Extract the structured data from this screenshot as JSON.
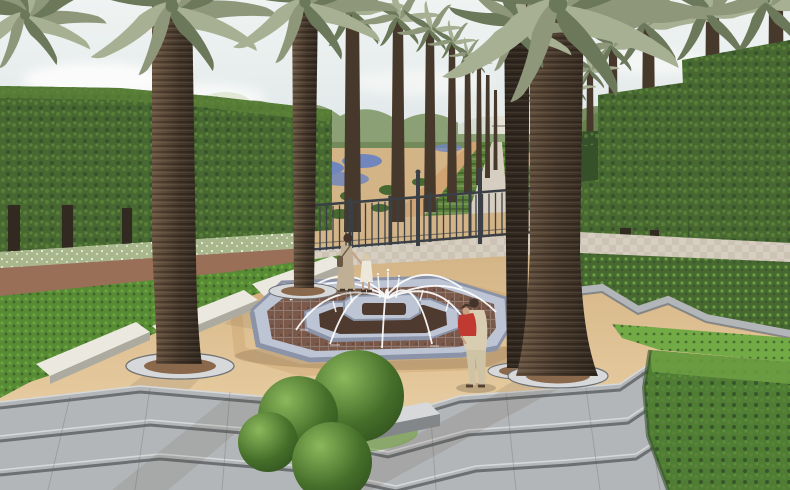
{
  "scene": {
    "type": "3d-architectural-rendering",
    "title": "Formal palm garden plaza with octagonal mosaic fountain",
    "time_of_day": "hazy daylight",
    "elements": {
      "sky": "pale hazy sky with soft white clouds",
      "background": "flowering treeline and a long receding avenue of palm trees",
      "left_hedge": "tall clipped hedge wall with a white-flower border and reddish gravel path",
      "right_hedges": "stepped clipped hedge walls with exposed trunks",
      "parterre": "central axis of rectangular planting strips with blue flower patches and a paved walk",
      "fence": "low dark metal railing with posts and taller gate posts separating plaza from gardens",
      "plaza": "sand-coloured esplanade with tall palms set in circular ringed tree pits",
      "fountain": "two-tier octagonal fountain, blue-grey tiled rims, reddish mosaic water basin, arcing white jets",
      "topiary": "cluster of clipped ball shrubs in a stone planter between step flights",
      "steps": "broad grey granite steps crossing the whole foreground",
      "planting_beds": "zig-zag stone-edged groundcover beds and a large clipped hedge block at lower right"
    },
    "people": [
      {
        "id": "woman-with-child",
        "description": "woman in a beige dress with shoulder bag holding hands with a small child in white, walking away",
        "position": "upper-left of fountain"
      },
      {
        "id": "man-with-child",
        "description": "man in cream clothes carrying a child in a red shirt, standing at the fountain edge",
        "position": "right of fountain"
      }
    ],
    "counts": {
      "foreground_palms": 4,
      "topiary_balls": 4,
      "fountain_jets": 9,
      "fence_posts": 7
    }
  },
  "palette": {
    "sky_top": "#eff3f2",
    "sky_low": "#d4dee1",
    "cloud": "#fdfdfc",
    "haze": "#e9ece8",
    "treeline": "#8ca076",
    "treeline_dark": "#5f7843",
    "blossom": "#dce3cd",
    "hedge_dark": "#36512a",
    "hedge_mid": "#476931",
    "hedge_light": "#5c8439",
    "hedge_top": "#6fa044",
    "hedge_bright": "#4f7d33",
    "bed_green": "#578c34",
    "bed_light": "#72aa45",
    "frond": "#8e977a",
    "frond_dark": "#6b785a",
    "frond_light": "#a8b093",
    "trunk_light": "#6e5944",
    "trunk_dark": "#46382b",
    "trunk_deep": "#322920",
    "sand": "#e1c497",
    "sand_light": "#edd8b0",
    "sand_dark": "#d3b486",
    "path_tan": "#cfa472",
    "path_red": "#996f57",
    "pit_soil": "#8a684c",
    "pave_light": "#d6cec0",
    "pave_dark": "#c2b8a7",
    "step_top": "#b3b6b8",
    "step_face": "#83878a",
    "step_edge": "#d6d8d9",
    "step_dark": "#6c7073",
    "curb_white": "#eae8df",
    "curb_side": "#adaba0",
    "rim_top": "#bdc4d4",
    "rim_side": "#8a93a8",
    "water": "#7a584a",
    "water_dark": "#4f3a2f",
    "grout": "#aaa39b",
    "jet": "#ffffff",
    "fence": "#3b4046",
    "flower_blue": "#7086bd",
    "flower_white": "#eef1e3",
    "struct": "#e5e1d6",
    "skin": "#c8a083",
    "hair": "#42342a",
    "dress_tan": "#bfb095",
    "dress_white": "#ede7d9",
    "man_cream": "#d8ccb1",
    "child_red": "#c03a31",
    "shadow": "#463a29"
  }
}
